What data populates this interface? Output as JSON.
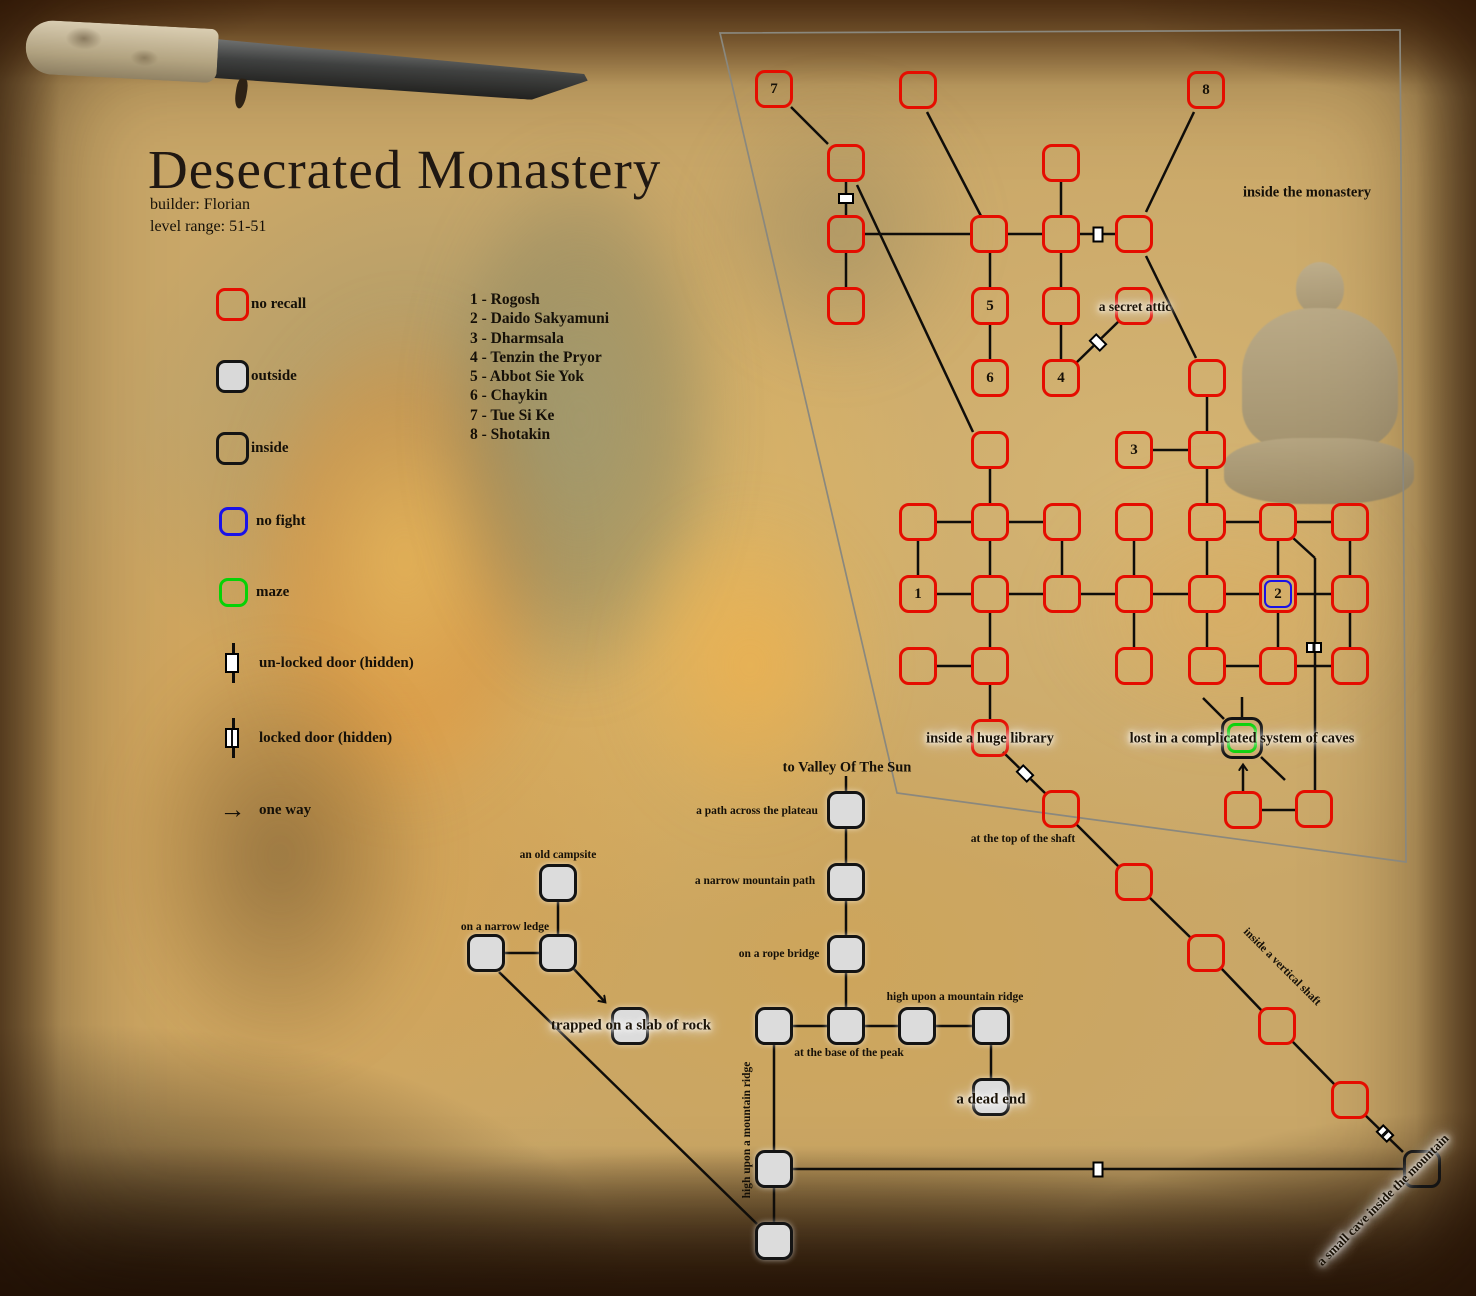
{
  "title": {
    "text": "Desecrated Monastery",
    "builder": "builder: Florian",
    "level_range": "level range: 51-51"
  },
  "legend": {
    "items": [
      {
        "type": "norecall",
        "label": "no recall"
      },
      {
        "type": "outside",
        "label": "outside"
      },
      {
        "type": "inside",
        "label": "inside"
      },
      {
        "type": "nofight",
        "label": "no fight"
      },
      {
        "type": "maze",
        "label": "maze"
      }
    ],
    "doors": [
      {
        "type": "unlocked",
        "label": "un-locked door (hidden)"
      },
      {
        "type": "locked",
        "label": "locked door (hidden)"
      }
    ],
    "one_way": {
      "label": "one way",
      "icon": "right-arrow-icon",
      "glyph": "→"
    }
  },
  "mobs": [
    "1 - Rogosh",
    "2 - Daido Sakyamuni",
    "3 - Dharmsala",
    "4 - Tenzin the Pryor",
    "5 - Abbot Sie Yok",
    "6 - Chaykin",
    "7 - Tue Si Ke",
    "8 - Shotakin"
  ],
  "colors": {
    "no_recall": "#e50d00",
    "no_fight": "#1a12e8",
    "maze": "#06d206",
    "inside": "#141414",
    "outside_fill": "#dcdcdc",
    "line": "#0f0d0a",
    "border": "#8a887e"
  },
  "map": {
    "border": [
      [
        720,
        33
      ],
      [
        1400,
        30
      ],
      [
        1406,
        862
      ],
      [
        897,
        793
      ]
    ],
    "rooms": [
      {
        "id": "7",
        "x": 774,
        "y": 89,
        "type": "norecall",
        "label": "7"
      },
      {
        "id": "top-mid",
        "x": 918,
        "y": 90,
        "type": "norecall"
      },
      {
        "id": "8",
        "x": 1206,
        "y": 90,
        "type": "norecall",
        "label": "8"
      },
      {
        "id": "a1",
        "x": 846,
        "y": 163,
        "type": "norecall"
      },
      {
        "id": "b1",
        "x": 1061,
        "y": 163,
        "type": "norecall"
      },
      {
        "id": "c1",
        "x": 846,
        "y": 234,
        "type": "norecall"
      },
      {
        "id": "c2",
        "x": 989,
        "y": 234,
        "type": "norecall"
      },
      {
        "id": "c3",
        "x": 1061,
        "y": 234,
        "type": "norecall"
      },
      {
        "id": "c4",
        "x": 1134,
        "y": 234,
        "type": "norecall"
      },
      {
        "id": "d1",
        "x": 846,
        "y": 306,
        "type": "norecall"
      },
      {
        "id": "5",
        "x": 990,
        "y": 306,
        "type": "norecall",
        "label": "5"
      },
      {
        "id": "d3",
        "x": 1061,
        "y": 306,
        "type": "norecall"
      },
      {
        "id": "secret-attic",
        "x": 1134,
        "y": 306,
        "type": "norecall"
      },
      {
        "id": "6",
        "x": 990,
        "y": 378,
        "type": "norecall",
        "label": "6"
      },
      {
        "id": "4",
        "x": 1061,
        "y": 378,
        "type": "norecall",
        "label": "4"
      },
      {
        "id": "e3",
        "x": 1207,
        "y": 378,
        "type": "norecall"
      },
      {
        "id": "f1",
        "x": 990,
        "y": 450,
        "type": "norecall"
      },
      {
        "id": "3",
        "x": 1134,
        "y": 450,
        "type": "norecall",
        "label": "3"
      },
      {
        "id": "f3",
        "x": 1207,
        "y": 450,
        "type": "norecall"
      },
      {
        "id": "g1",
        "x": 918,
        "y": 522,
        "type": "norecall"
      },
      {
        "id": "g2",
        "x": 990,
        "y": 522,
        "type": "norecall"
      },
      {
        "id": "g3",
        "x": 1062,
        "y": 522,
        "type": "norecall"
      },
      {
        "id": "g4",
        "x": 1134,
        "y": 522,
        "type": "norecall"
      },
      {
        "id": "g5",
        "x": 1207,
        "y": 522,
        "type": "norecall"
      },
      {
        "id": "g6",
        "x": 1278,
        "y": 522,
        "type": "norecall"
      },
      {
        "id": "g7",
        "x": 1350,
        "y": 522,
        "type": "norecall"
      },
      {
        "id": "1",
        "x": 918,
        "y": 594,
        "type": "norecall",
        "label": "1"
      },
      {
        "id": "h2",
        "x": 990,
        "y": 594,
        "type": "norecall"
      },
      {
        "id": "h3",
        "x": 1062,
        "y": 594,
        "type": "norecall"
      },
      {
        "id": "h4",
        "x": 1134,
        "y": 594,
        "type": "norecall"
      },
      {
        "id": "h5",
        "x": 1207,
        "y": 594,
        "type": "norecall"
      },
      {
        "id": "2",
        "x": 1278,
        "y": 594,
        "type": "nofight",
        "label": "2"
      },
      {
        "id": "h7",
        "x": 1350,
        "y": 594,
        "type": "norecall"
      },
      {
        "id": "i1",
        "x": 918,
        "y": 666,
        "type": "norecall"
      },
      {
        "id": "i2",
        "x": 990,
        "y": 666,
        "type": "norecall"
      },
      {
        "id": "i3",
        "x": 1134,
        "y": 666,
        "type": "norecall"
      },
      {
        "id": "i4",
        "x": 1207,
        "y": 666,
        "type": "norecall"
      },
      {
        "id": "i5",
        "x": 1278,
        "y": 666,
        "type": "norecall"
      },
      {
        "id": "i6",
        "x": 1350,
        "y": 666,
        "type": "norecall"
      },
      {
        "id": "library",
        "x": 990,
        "y": 738,
        "type": "norecall"
      },
      {
        "id": "maze-caves",
        "x": 1242,
        "y": 738,
        "type": "maze"
      },
      {
        "id": "j1",
        "x": 1243,
        "y": 810,
        "type": "norecall"
      },
      {
        "id": "j2",
        "x": 1314,
        "y": 809,
        "type": "norecall"
      },
      {
        "id": "shaft-top",
        "x": 1061,
        "y": 809,
        "type": "norecall"
      },
      {
        "id": "k2",
        "x": 1134,
        "y": 882,
        "type": "norecall"
      },
      {
        "id": "k3",
        "x": 1206,
        "y": 953,
        "type": "norecall"
      },
      {
        "id": "k4",
        "x": 1277,
        "y": 1026,
        "type": "norecall"
      },
      {
        "id": "k5",
        "x": 1350,
        "y": 1100,
        "type": "norecall"
      },
      {
        "id": "small-cave",
        "x": 1422,
        "y": 1169,
        "type": "inside"
      },
      {
        "id": "campsite",
        "x": 558,
        "y": 883,
        "type": "outside"
      },
      {
        "id": "ledge-left",
        "x": 486,
        "y": 953,
        "type": "outside"
      },
      {
        "id": "ledge-right",
        "x": 558,
        "y": 953,
        "type": "outside"
      },
      {
        "id": "slab",
        "x": 630,
        "y": 1026,
        "type": "outside"
      },
      {
        "id": "plateau",
        "x": 846,
        "y": 810,
        "type": "outside"
      },
      {
        "id": "narrow-path",
        "x": 846,
        "y": 882,
        "type": "outside"
      },
      {
        "id": "rope-bridge",
        "x": 846,
        "y": 954,
        "type": "outside"
      },
      {
        "id": "base1",
        "x": 774,
        "y": 1026,
        "type": "outside"
      },
      {
        "id": "base2",
        "x": 846,
        "y": 1026,
        "type": "outside"
      },
      {
        "id": "base3",
        "x": 917,
        "y": 1026,
        "type": "outside"
      },
      {
        "id": "base4",
        "x": 991,
        "y": 1026,
        "type": "outside"
      },
      {
        "id": "dead-end",
        "x": 991,
        "y": 1097,
        "type": "outside"
      },
      {
        "id": "ridge1",
        "x": 774,
        "y": 1169,
        "type": "outside"
      },
      {
        "id": "ridge2",
        "x": 774,
        "y": 1241,
        "type": "outside"
      }
    ],
    "edges": [
      [
        791,
        107,
        828,
        144
      ],
      [
        927,
        112,
        981,
        216
      ],
      [
        1194,
        112,
        1146,
        212
      ],
      [
        1146,
        256,
        1196,
        358
      ],
      [
        846,
        182,
        846,
        215
      ],
      [
        857,
        185,
        973,
        432
      ],
      [
        865,
        234,
        970,
        234
      ],
      [
        1008,
        234,
        1042,
        234
      ],
      [
        1080,
        234,
        1115,
        234
      ],
      [
        846,
        253,
        846,
        287
      ],
      [
        990,
        253,
        990,
        287
      ],
      [
        1061,
        253,
        1061,
        287
      ],
      [
        1061,
        182,
        1061,
        215
      ],
      [
        990,
        325,
        990,
        359
      ],
      [
        1061,
        325,
        1061,
        359
      ],
      [
        1075,
        364,
        1119,
        321
      ],
      [
        1207,
        397,
        1207,
        431
      ],
      [
        1153,
        450,
        1188,
        450
      ],
      [
        990,
        469,
        990,
        503
      ],
      [
        1207,
        469,
        1207,
        503
      ],
      [
        937,
        522,
        971,
        522
      ],
      [
        1009,
        522,
        1043,
        522
      ],
      [
        1226,
        522,
        1259,
        522
      ],
      [
        1297,
        522,
        1331,
        522
      ],
      [
        918,
        541,
        918,
        575
      ],
      [
        990,
        541,
        990,
        575
      ],
      [
        1062,
        541,
        1062,
        575
      ],
      [
        1134,
        541,
        1134,
        575
      ],
      [
        1207,
        541,
        1207,
        575
      ],
      [
        1278,
        541,
        1278,
        575
      ],
      [
        1350,
        541,
        1350,
        575
      ],
      [
        937,
        594,
        971,
        594
      ],
      [
        1009,
        594,
        1043,
        594
      ],
      [
        1081,
        594,
        1115,
        594
      ],
      [
        1153,
        594,
        1188,
        594
      ],
      [
        1226,
        594,
        1259,
        594
      ],
      [
        1297,
        594,
        1331,
        594
      ],
      [
        990,
        613,
        990,
        647
      ],
      [
        1134,
        613,
        1134,
        647
      ],
      [
        1207,
        613,
        1207,
        647
      ],
      [
        1278,
        613,
        1278,
        647
      ],
      [
        1350,
        613,
        1350,
        647
      ],
      [
        937,
        666,
        971,
        666
      ],
      [
        1226,
        666,
        1259,
        666
      ],
      [
        1297,
        666,
        1331,
        666
      ],
      [
        990,
        685,
        990,
        719
      ],
      [
        1003,
        752,
        1047,
        795
      ],
      [
        1075,
        823,
        1120,
        868
      ],
      [
        1148,
        896,
        1192,
        939
      ],
      [
        1220,
        967,
        1263,
        1012
      ],
      [
        1291,
        1040,
        1336,
        1086
      ],
      [
        1364,
        1114,
        1403,
        1152
      ],
      [
        1292,
        537,
        1315,
        558
      ],
      [
        1315,
        558,
        1315,
        790
      ],
      [
        1203,
        698,
        1224,
        719
      ],
      [
        1242,
        697,
        1242,
        717
      ],
      [
        1261,
        757,
        1285,
        780
      ],
      [
        1262,
        810,
        1295,
        810
      ],
      [
        558,
        902,
        558,
        934
      ],
      [
        505,
        953,
        539,
        953
      ],
      [
        499,
        972,
        757,
        1224
      ],
      [
        846,
        776,
        846,
        791
      ],
      [
        846,
        829,
        846,
        863
      ],
      [
        846,
        901,
        846,
        935
      ],
      [
        846,
        973,
        846,
        1007
      ],
      [
        793,
        1026,
        827,
        1026
      ],
      [
        865,
        1026,
        898,
        1026
      ],
      [
        936,
        1026,
        972,
        1026
      ],
      [
        991,
        1045,
        991,
        1078
      ],
      [
        774,
        1045,
        774,
        1150
      ],
      [
        774,
        1188,
        774,
        1222
      ],
      [
        793,
        1169,
        1403,
        1169
      ]
    ],
    "arrows": [
      [
        572,
        967,
        605,
        1002
      ],
      [
        1243,
        791,
        1243,
        765
      ]
    ],
    "doors": [
      {
        "x": 846,
        "y": 198,
        "rot": 0,
        "type": "unlocked"
      },
      {
        "x": 1098,
        "y": 234,
        "rot": 90,
        "type": "unlocked"
      },
      {
        "x": 1098,
        "y": 342,
        "rot": 45,
        "type": "unlocked"
      },
      {
        "x": 1314,
        "y": 647,
        "rot": 0,
        "type": "locked"
      },
      {
        "x": 1025,
        "y": 773,
        "rot": 45,
        "type": "unlocked"
      },
      {
        "x": 1385,
        "y": 1133,
        "rot": 45,
        "type": "locked"
      },
      {
        "x": 1098,
        "y": 1169,
        "rot": 90,
        "type": "unlocked"
      }
    ],
    "labels": [
      {
        "text": "inside the monastery",
        "x": 1307,
        "y": 193,
        "size": 14.5
      },
      {
        "text": "a secret attic",
        "x": 1135,
        "y": 307,
        "size": 13.5,
        "glow": true
      },
      {
        "text": "inside a huge library",
        "x": 990,
        "y": 739,
        "size": 14.5,
        "glow": true
      },
      {
        "text": "lost in a complicated system of caves",
        "x": 1242,
        "y": 739,
        "size": 14.5,
        "glow": true
      },
      {
        "text": "at the top of the shaft",
        "x": 1023,
        "y": 839,
        "size": 11.5
      },
      {
        "text": "inside a vertical shaft",
        "x": 1282,
        "y": 967,
        "size": 11.5,
        "rot": 45
      },
      {
        "text": "a small cave inside the mountain",
        "x": 1383,
        "y": 1200,
        "size": 13,
        "rot": -45,
        "glow": true
      },
      {
        "text": "to Valley Of The Sun",
        "x": 847,
        "y": 768,
        "size": 14.5
      },
      {
        "text": "a path across the plateau",
        "x": 757,
        "y": 811,
        "size": 11.5
      },
      {
        "text": "a narrow mountain path",
        "x": 755,
        "y": 881,
        "size": 11.5
      },
      {
        "text": "on a rope bridge",
        "x": 779,
        "y": 954,
        "size": 11.5
      },
      {
        "text": "high upon a mountain ridge",
        "x": 955,
        "y": 997,
        "size": 11.5
      },
      {
        "text": "at the base of the peak",
        "x": 849,
        "y": 1053,
        "size": 11.5
      },
      {
        "text": "a dead end",
        "x": 991,
        "y": 1100,
        "size": 15,
        "glow": true
      },
      {
        "text": "trapped on a slab of rock",
        "x": 631,
        "y": 1026,
        "size": 15,
        "glow": true
      },
      {
        "text": "an old campsite",
        "x": 558,
        "y": 855,
        "size": 11.5
      },
      {
        "text": "on a narrow ledge",
        "x": 505,
        "y": 927,
        "size": 11.5
      },
      {
        "text": "high upon a mountain ridge",
        "x": 747,
        "y": 1130,
        "size": 11.5,
        "rot": -90
      }
    ]
  }
}
